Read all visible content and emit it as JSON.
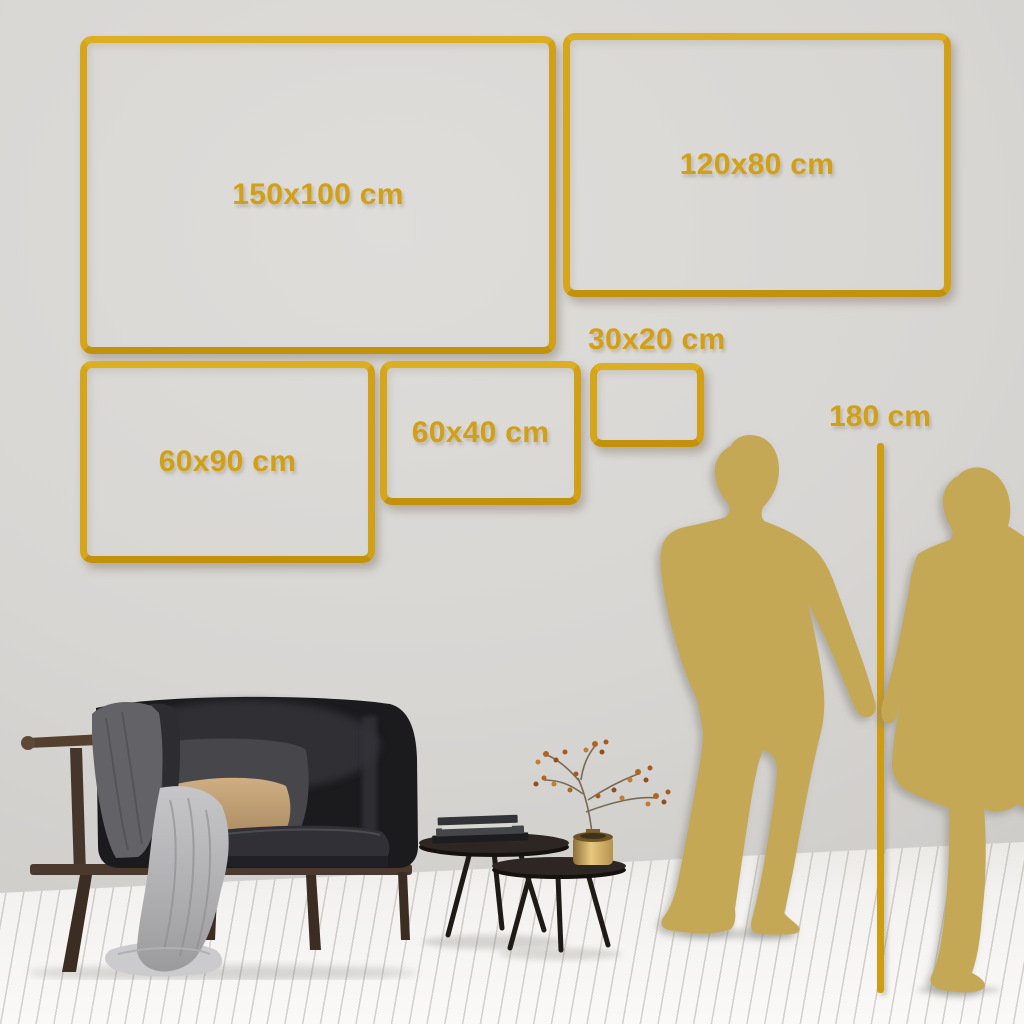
{
  "colors": {
    "accent_gold": "#d2a016",
    "silhouette_gold": "#c4a855",
    "wall": "#d8d6d3",
    "floor": "#f3f2f0"
  },
  "size_guide": {
    "frames": [
      {
        "id": "150x100",
        "label": "150x100 cm"
      },
      {
        "id": "120x80",
        "label": "120x80 cm"
      },
      {
        "id": "60x90",
        "label": "60x90 cm"
      },
      {
        "id": "60x40",
        "label": "60x40 cm"
      },
      {
        "id": "30x20",
        "label": "30x20 cm"
      }
    ],
    "height_reference": {
      "label": "180 cm"
    }
  }
}
